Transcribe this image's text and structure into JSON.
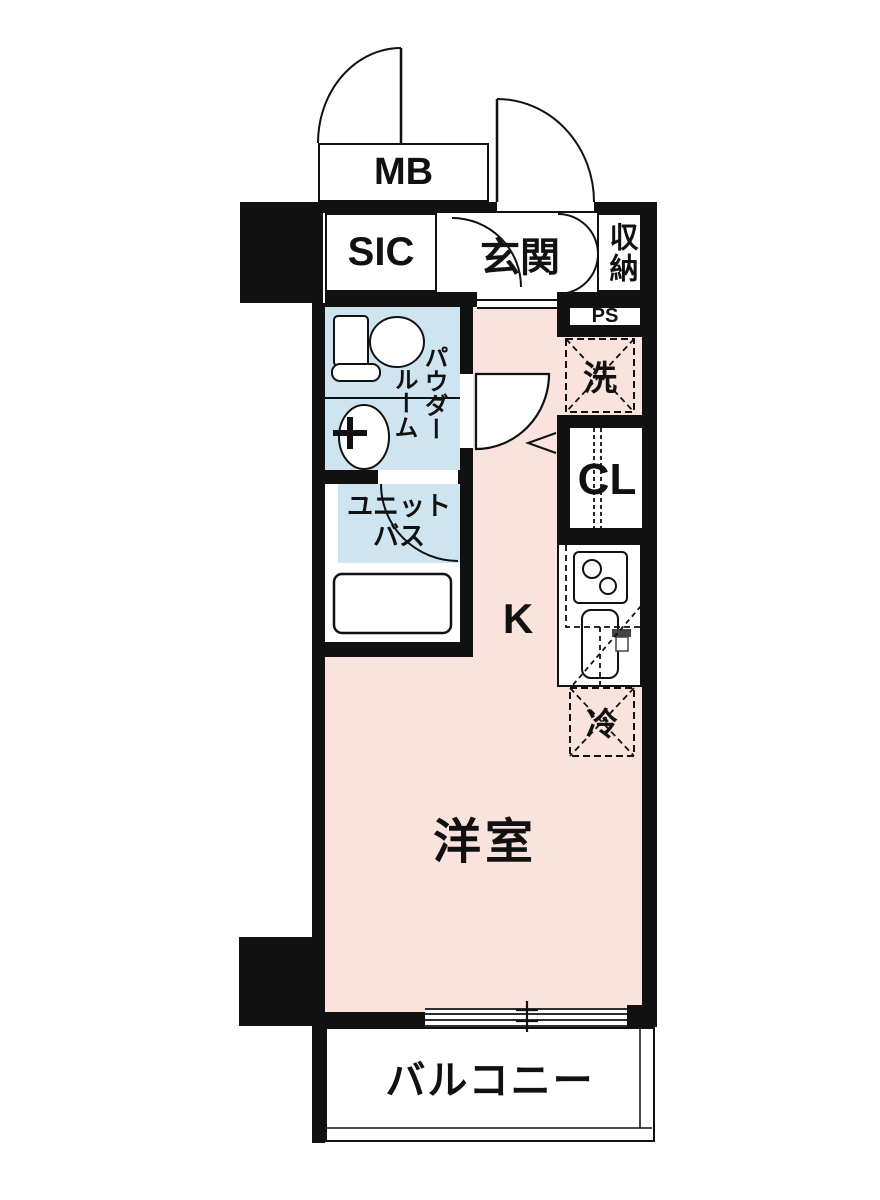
{
  "floor_plan": {
    "labels": {
      "meter_box": "MB",
      "shoe_closet": "SIC",
      "entrance": "玄関",
      "storage": "収納",
      "pipe_space": "PS",
      "washer": "洗",
      "closet": "CL",
      "powder_room_line1": "パウダー",
      "powder_room_line2": "ルーム",
      "unit_bath_line1": "ユニット",
      "unit_bath_line2": "バス",
      "kitchen": "K",
      "refrigerator": "冷",
      "western_room": "洋室",
      "balcony": "バルコニー"
    },
    "colors": {
      "wall": "#111111",
      "room_floor": "#f9e3dc",
      "wet_area_floor": "#cfe4f1",
      "background": "#ffffff",
      "line": "#111111"
    }
  }
}
